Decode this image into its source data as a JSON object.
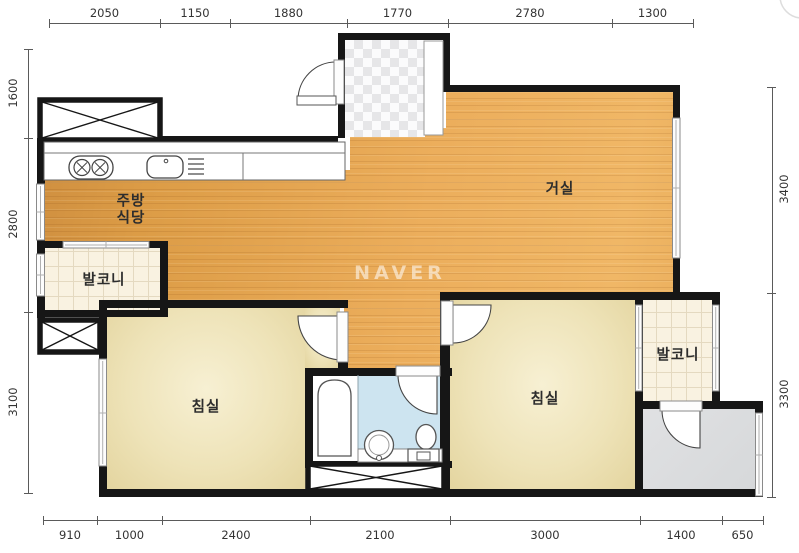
{
  "watermark": {
    "text": "NAVER"
  },
  "rooms": [
    {
      "name": "kitchen-dining",
      "label": "주방\n식당",
      "cx": 131,
      "cy": 210
    },
    {
      "name": "living-room",
      "label": "거실",
      "cx": 560,
      "cy": 190
    },
    {
      "name": "balcony-left",
      "label": "발코니",
      "cx": 104,
      "cy": 281
    },
    {
      "name": "balcony-right",
      "label": "발코니",
      "cx": 678,
      "cy": 356
    },
    {
      "name": "bedroom-left",
      "label": "침실",
      "cx": 206,
      "cy": 408
    },
    {
      "name": "bedroom-right",
      "label": "침실",
      "cx": 545,
      "cy": 400
    }
  ],
  "dimensions_mm": {
    "top": {
      "labels": [
        "2050",
        "1150",
        "1880",
        "1770",
        "2780",
        "1300"
      ],
      "ticks": [
        49,
        160,
        230,
        347,
        448,
        612,
        693
      ],
      "line_y": 23
    },
    "bottom": {
      "labels": [
        "910",
        "1000",
        "2400",
        "2100",
        "3000",
        "1400",
        "650"
      ],
      "ticks": [
        43,
        97,
        162,
        310,
        450,
        640,
        722,
        763
      ],
      "line_y": 520
    },
    "left": {
      "labels": [
        "1600",
        "2800",
        "3100"
      ],
      "ticks": [
        49,
        138,
        312,
        493
      ],
      "line_x": 28
    },
    "right": {
      "labels": [
        "3400",
        "3300"
      ],
      "ticks": [
        87,
        293,
        497
      ],
      "line_x": 772
    }
  },
  "fixtures": [
    "stove-2-burner",
    "kitchen-sink",
    "dish-drainer",
    "bathtub",
    "wash-basin",
    "toilet",
    "shoe-cabinet",
    "closet-x-box",
    "storage-x-box"
  ],
  "colors": {
    "wall": "#161616",
    "wood_floor": "#ecae5c",
    "bedroom_floor": "#eee3b8",
    "balcony_tile": "#f9f2e1",
    "bathroom_tile": "#cde4f0",
    "utility_floor": "#dcdee0",
    "entrance_checker": "#e6e6e8",
    "dimension_text": "#333333"
  }
}
